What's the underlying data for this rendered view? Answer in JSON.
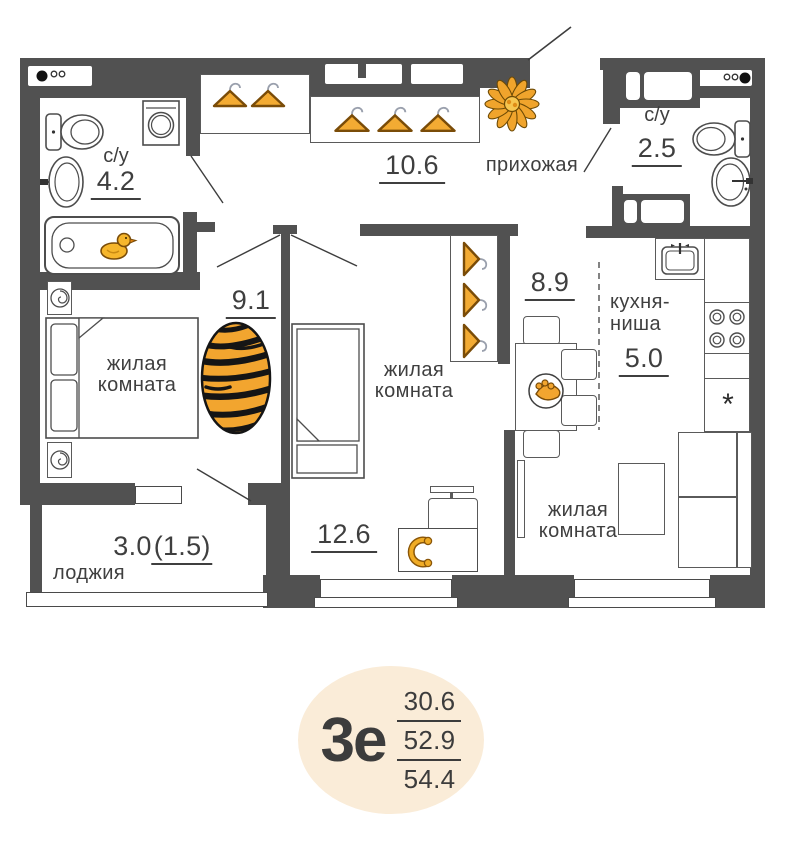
{
  "plan_title": "apartment floor plan",
  "colors": {
    "wall": "#515151",
    "accent_orange": "#f0a42c",
    "badge_bg": "#faecd8",
    "text": "#3f3f3f",
    "stripe_black": "#151515"
  },
  "rooms": {
    "bathroom_small": {
      "label": "с/у",
      "area": "4.2"
    },
    "hallway": {
      "name": "прихожая",
      "area": "10.6"
    },
    "bathroom_guest": {
      "label": "с/у",
      "area": "2.5"
    },
    "bedroom": {
      "name_line1": "жилая",
      "name_line2": "комната",
      "area": "9.1"
    },
    "room_middle": {
      "name_line1": "жилая",
      "name_line2": "комната",
      "area": "12.6"
    },
    "dining_zone": {
      "area": "8.9"
    },
    "kitchen_niche": {
      "name_line1": "кухня-",
      "name_line2": "ниша",
      "area": "5.0"
    },
    "living_room": {
      "name_line1": "жилая",
      "name_line2": "комната"
    },
    "loggia": {
      "name": "лоджия",
      "area_full": "3.0",
      "area_counted": "(1.5)"
    }
  },
  "badge": {
    "plan_type": "3е",
    "area_living": "30.6",
    "area_main": "52.9",
    "area_total": "54.4"
  },
  "symbols": {
    "fridge_mark": "*"
  },
  "icons": {
    "vent": "vent-dots-icon",
    "toilet": "toilet-icon",
    "sink": "sink-icon",
    "bathtub": "bathtub-icon",
    "duck": "rubber-duck-icon",
    "washing_machine": "washing-machine-icon",
    "hanger": "hanger-icon",
    "flower": "flower-icon",
    "double_bed": "double-bed-icon",
    "single_bed": "single-bed-icon",
    "lamp": "bedside-lamp-icon",
    "rug": "tiger-rug-icon",
    "desk": "desk-icon",
    "headphones": "headphones-icon",
    "dining_table": "dining-table-icon",
    "fruit_bowl": "fruit-bowl-icon",
    "kitchen_sink": "kitchen-sink-icon",
    "stove": "stove-burners-icon",
    "sofa": "sofa-icon",
    "coffee_table": "coffee-table-icon",
    "radiator": "radiator-icon"
  }
}
